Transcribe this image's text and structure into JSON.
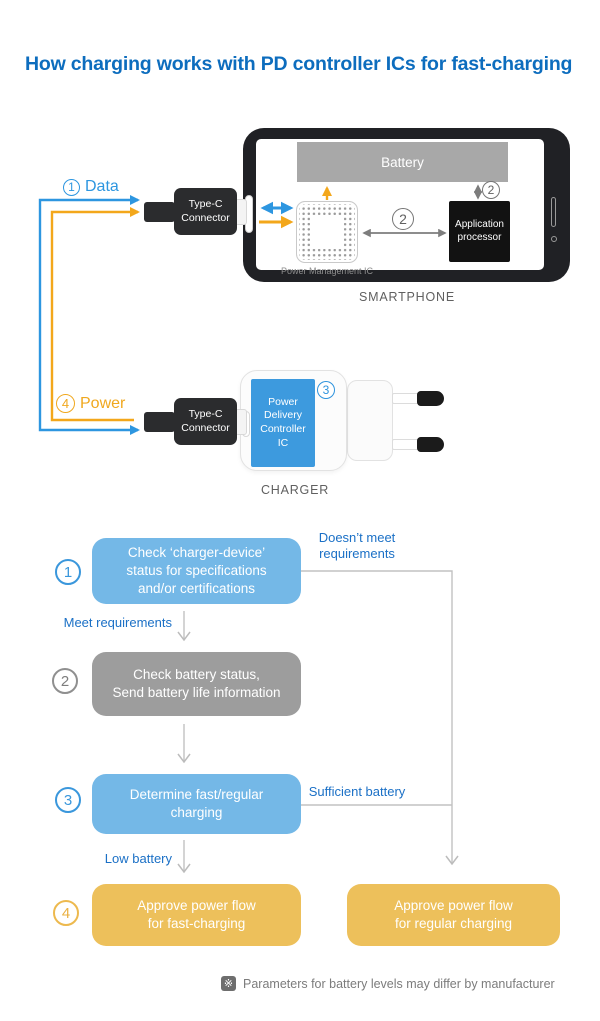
{
  "title": "How charging works with PD controller ICs for fast-charging",
  "colors": {
    "title_blue": "#0d6dbe",
    "flow_blue": "#74b8e7",
    "flow_gray": "#9d9d9d",
    "flow_orange": "#edc05b",
    "data_blue": "#2d96e0",
    "power_orange": "#f3a71b",
    "label_blue": "#1b70c6"
  },
  "smartphone": {
    "caption": "SMARTPHONE",
    "battery_label": "Battery",
    "pmic_label": "Power Management IC",
    "processor_label": "Application\nprocessor",
    "bus_badge": "2",
    "battery_badge": "2"
  },
  "typec": {
    "label": "Type-C\nConnector"
  },
  "charger": {
    "caption": "CHARGER",
    "pd_ic_label": "Power\nDelivery\nController\nIC",
    "badge": "3"
  },
  "data_line": {
    "badge": "1",
    "label": "Data"
  },
  "power_line": {
    "badge": "4",
    "label": "Power"
  },
  "flow": {
    "step1": {
      "badge": "1",
      "text": "Check ‘charger-device’\nstatus for specifications\nand/or certifications"
    },
    "step2": {
      "badge": "2",
      "text": "Check battery status,\nSend battery life information"
    },
    "step3": {
      "badge": "3",
      "text": "Determine fast/regular\ncharging"
    },
    "step4": {
      "badge": "4",
      "text": "Approve power flow\nfor fast-charging"
    },
    "step4b": {
      "text": "Approve power flow\nfor regular charging"
    },
    "labels": {
      "doesnt_meet": "Doesn’t meet\nrequirements",
      "meet": "Meet requirements",
      "sufficient": "Sufficient battery",
      "low": "Low battery"
    }
  },
  "footnote": {
    "icon": "※",
    "text": "Parameters for battery levels may differ by manufacturer"
  }
}
